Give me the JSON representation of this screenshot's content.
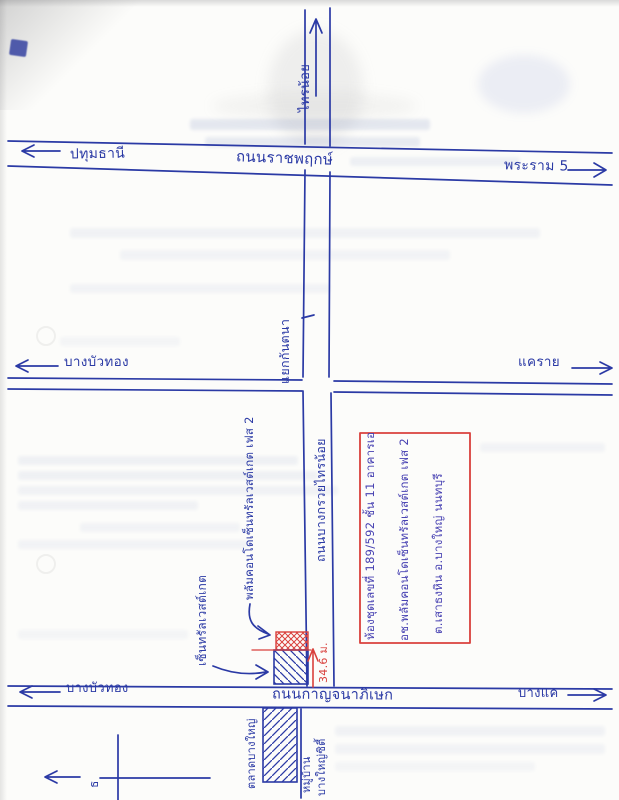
{
  "document": {
    "kind": "hand-drawn location sketch map on scanned paper"
  },
  "roads": {
    "ratchaphruek": {
      "name": "ถนนราชพฤกษ์",
      "left_destination": "ปทุมธานี",
      "right_destination": "พระราม 5"
    },
    "rattanathibet": {
      "left_destination": "บางบัวทอง",
      "right_destination": "แคราย"
    },
    "kanchanaphisek": {
      "name": "ถนนกาญจนาภิเษก",
      "left_destination": "บางบัวทอง",
      "right_destination": "บางแค"
    },
    "bang_kruai_sai_noi": {
      "name": "ถนนบางกรวยไทรน้อย",
      "north_destination": "ไทรน้อย",
      "junction": "แยกกันตนา"
    }
  },
  "landmarks": {
    "condo": "พลัมคอนโดเซ็นทรัลเวสต์เกต เฟส 2",
    "central_westgate": "เซ็นทรัลเวสต์เกต",
    "market": "ตลาดบางใหญ่",
    "village_line1": "หมู่บ้าน",
    "village_line2": "บางใหญ่ซิตี้",
    "inset_glyph": "ธ"
  },
  "measurement": {
    "distance": "34.6 ม."
  },
  "info_box": {
    "line1": "ห้องชุดเลขที่ 189/592 ชั้น 11 อาคารเอ",
    "line2": "อช.พลัมคอนโดเซ็นทรัลเวสต์เกต เฟส 2",
    "line3": "ต.เสาธงหิน อ.บางใหญ่ นนทบุรี"
  },
  "colors": {
    "ink_blue": "#2b3aa5",
    "red": "#d9403c",
    "box_ink": "#4741b2"
  }
}
